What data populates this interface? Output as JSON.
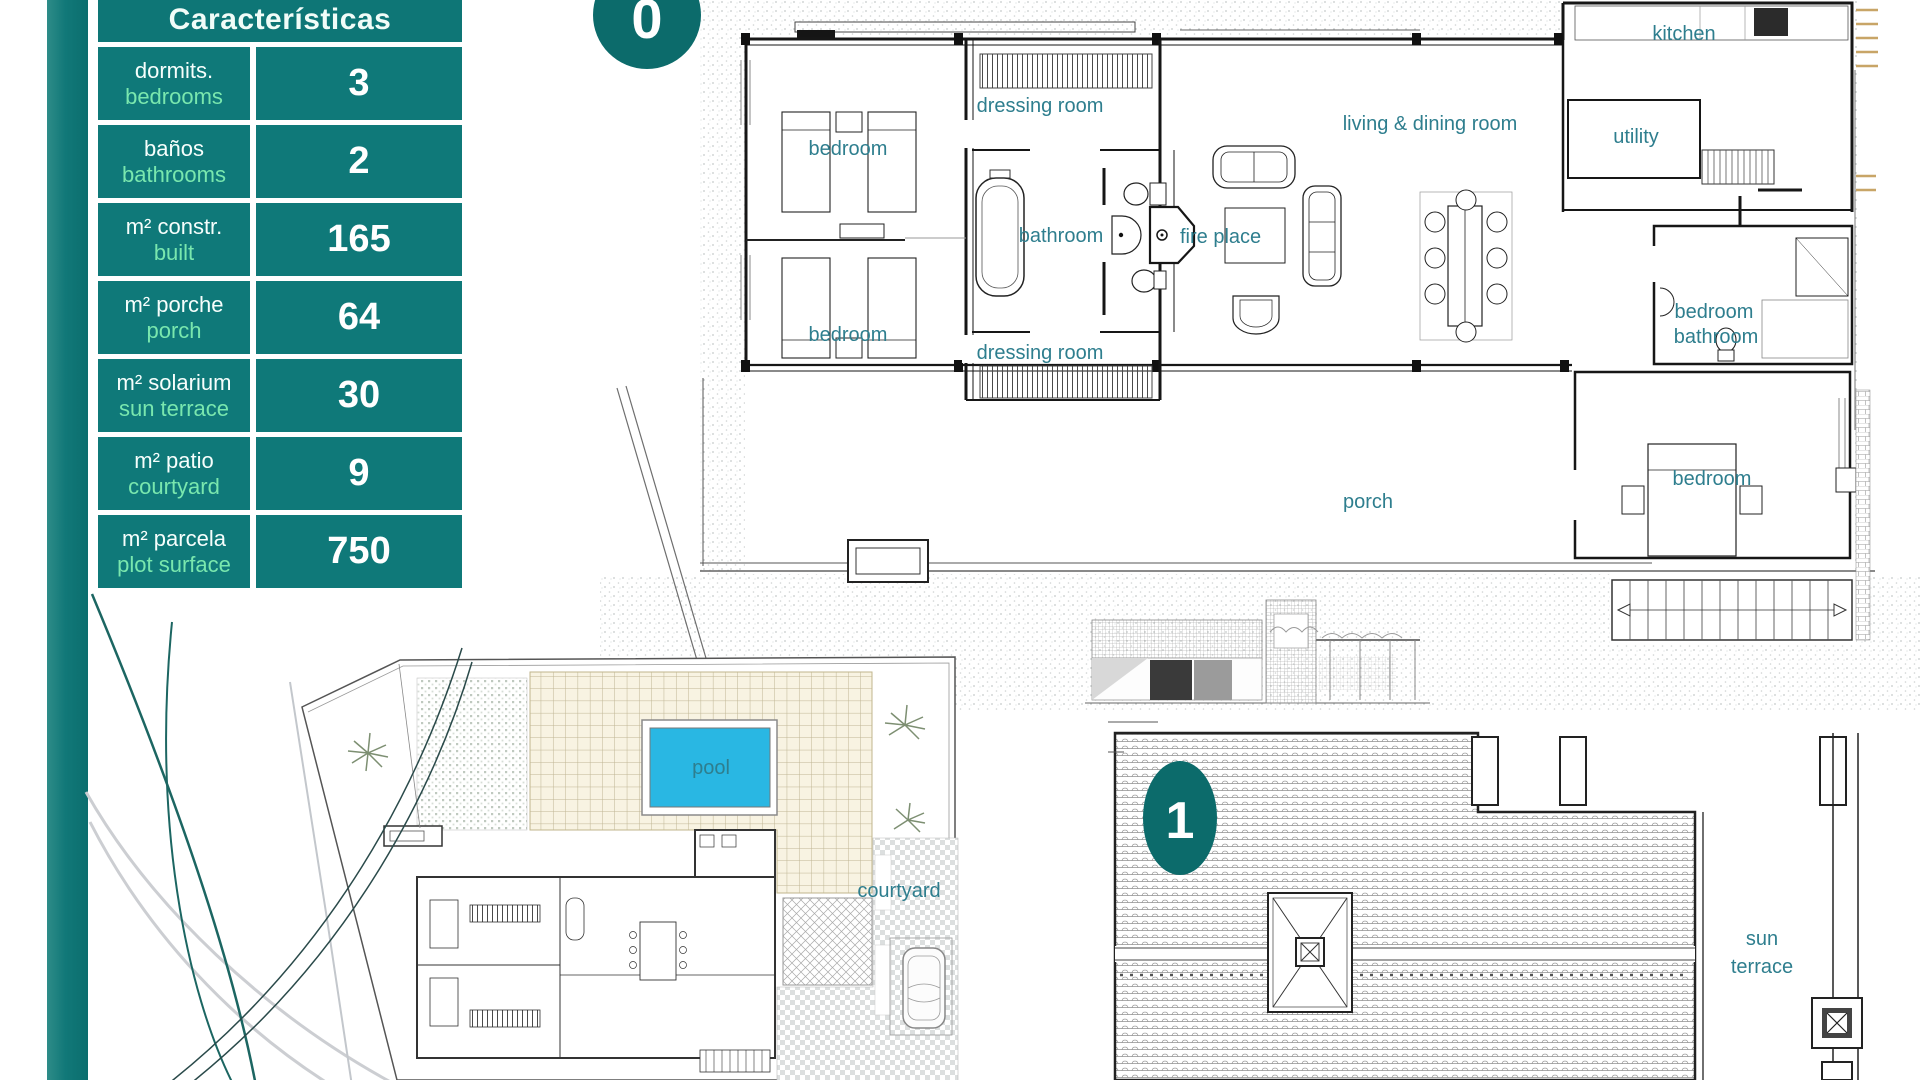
{
  "table": {
    "title": "Características",
    "rows": [
      {
        "es": "dormits.",
        "en": "bedrooms",
        "value": "3"
      },
      {
        "es": "baños",
        "en": "bathrooms",
        "value": "2"
      },
      {
        "es": "m² constr.",
        "en": "built",
        "value": "165"
      },
      {
        "es": "m² porche",
        "en": "porch",
        "value": "64"
      },
      {
        "es": "m² solarium",
        "en": "sun terrace",
        "value": "30"
      },
      {
        "es": "m² patio",
        "en": "courtyard",
        "value": "9"
      },
      {
        "es": "m² parcela",
        "en": "plot surface",
        "value": "750"
      }
    ]
  },
  "badges": {
    "floor0": "0",
    "floor1": "1"
  },
  "labels": {
    "kitchen": "kitchen",
    "dressing_room": "dressing room",
    "bedroom": "bedroom",
    "living_dining": "living & dining room",
    "utility": "utility",
    "bathroom": "bathroom",
    "fire_place": "fire place",
    "porch": "porch",
    "pool": "pool",
    "courtyard": "courtyard",
    "sun": "sun",
    "terrace": "terrace"
  },
  "colors": {
    "accent_teal": "#117878",
    "badge_teal": "#0c6b6b",
    "room_label": "#2e7e8e",
    "english_mint": "#79e7ae",
    "pool_water": "#29b7e3",
    "terrace_tile": "#f8f3e2"
  }
}
